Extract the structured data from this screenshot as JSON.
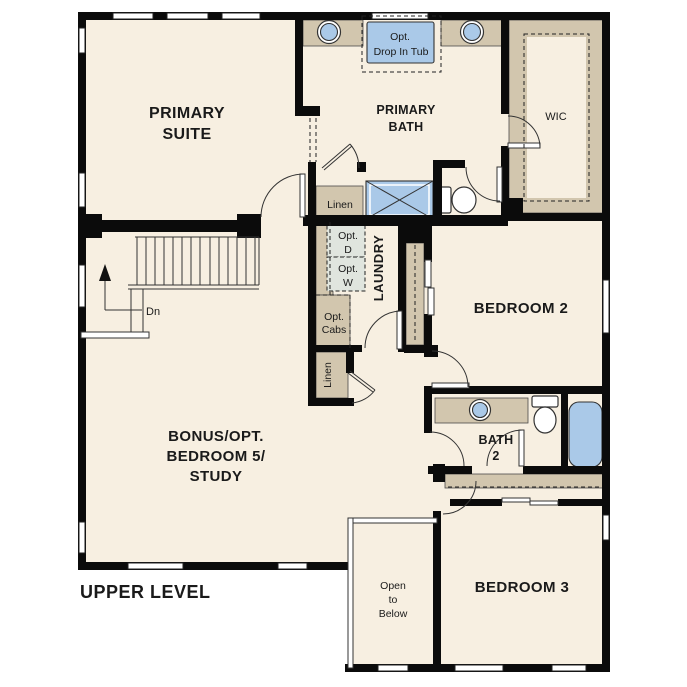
{
  "plan": {
    "title": "UPPER LEVEL"
  },
  "palette": {
    "wall": "#0b0b0b",
    "floor": "#f7efe1",
    "cabinet": "#d2c6ae",
    "fixture": "#aac9e8",
    "appliance": "#e0e5de",
    "ink": "#1a1a1a"
  },
  "rooms": {
    "primary_suite": {
      "lines": [
        "PRIMARY",
        "SUITE"
      ]
    },
    "primary_bath": {
      "lines": [
        "PRIMARY",
        "BATH"
      ]
    },
    "wic": {
      "label": "WIC"
    },
    "laundry": {
      "label": "LAUNDRY"
    },
    "bedroom2": {
      "label": "BEDROOM 2"
    },
    "bath2": {
      "lines": [
        "BATH",
        "2"
      ]
    },
    "bedroom3": {
      "label": "BEDROOM 3"
    },
    "bonus": {
      "lines": [
        "BONUS/OPT.",
        "BEDROOM 5/",
        "STUDY"
      ]
    },
    "open_below": {
      "lines": [
        "Open",
        "to",
        "Below"
      ]
    }
  },
  "features": {
    "opt_tub": {
      "lines": [
        "Opt.",
        "Drop In Tub"
      ]
    },
    "linen_upper": {
      "label": "Linen"
    },
    "linen_lower": {
      "label": "Linen"
    },
    "opt_dryer": {
      "lines": [
        "Opt.",
        "D"
      ]
    },
    "opt_washer": {
      "lines": [
        "Opt.",
        "W"
      ]
    },
    "opt_cabs": {
      "lines": [
        "Opt.",
        "Cabs"
      ]
    },
    "stairs_down": {
      "label": "Dn"
    }
  }
}
